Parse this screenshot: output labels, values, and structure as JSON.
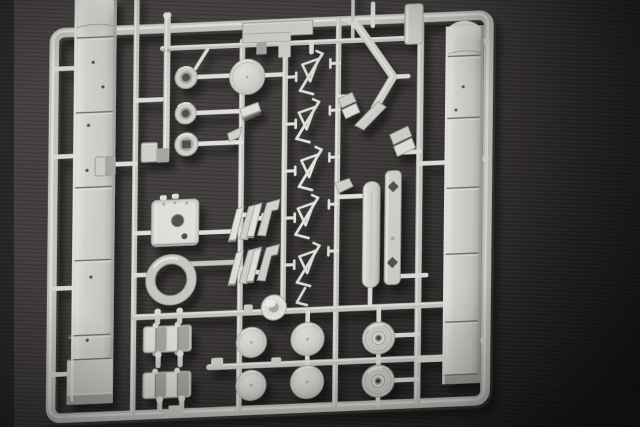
{
  "scene": {
    "type": "photograph",
    "subject": "Light grey injection-moulded model kit sprue (parts tree) photographed on dark grey fabric",
    "background": "dark charcoal fabric with vignetting, darker toward right edge and corners",
    "lighting": "flash from upper left; parts cast soft shadows down and to the right"
  },
  "colors": {
    "bg_base": "#433f3d",
    "bg_dark": "#1c1919",
    "bg_edge": "#0d0b0b",
    "runner": "#ccd0c9",
    "plastic": "#d4d7d1",
    "plastic_bright": "#e6e8e3",
    "plastic_highlight": "#f4f5f1",
    "plastic_shadow": "#a8aba5",
    "plastic_dark": "#6e716b",
    "crevice": "#504e48"
  },
  "sprue": {
    "frame": "rounded rectangular outer runner, slightly tilted (right side higher)",
    "interior_runners": [
      "5 vertical rails",
      "top cross rail",
      "two lower cross rails",
      "many short feed stubs"
    ],
    "parts": [
      {
        "id": "left-fender",
        "label": "long segmented fender strip with rolled top and locating holes (left side)"
      },
      {
        "id": "right-fender",
        "label": "long segmented fender strip with rolled top (right side)"
      },
      {
        "id": "gun-barrel",
        "label": "thin gun-barrel rod (upper middle)"
      },
      {
        "id": "hub-rings",
        "label": "column of three small wheel hubs / ring parts"
      },
      {
        "id": "hatch-disc",
        "label": "round hatch disc"
      },
      {
        "id": "turret-box",
        "label": "rectangular turret block with two round openings"
      },
      {
        "id": "large-ring",
        "label": "large open ring (turret race)"
      },
      {
        "id": "zigzag-chain",
        "label": "vertical chain of thin zig-zag parts with hollow triangles"
      },
      {
        "id": "wedge-pairs",
        "label": "two rows of paired slanted bracket parts"
      },
      {
        "id": "right-wedges",
        "label": "small slanted plate parts right of the chain"
      },
      {
        "id": "arrow-bracket",
        "label": "large chevron / arrow-shaped bracket (top right)"
      },
      {
        "id": "roof-plate",
        "label": "flat stepped plate with hanging tabs (top middle)"
      },
      {
        "id": "hanging-block",
        "label": "small block hanging from top rail (right)"
      },
      {
        "id": "support-bar",
        "label": "rounded vertical support bar"
      },
      {
        "id": "plate-bar",
        "label": "flat bar with diamond cut-outs"
      },
      {
        "id": "track-links",
        "label": "two track-link clusters with round-tipped sprue pins"
      },
      {
        "id": "road-wheels",
        "label": "four plain round road wheels (bottom)"
      },
      {
        "id": "hub-wheels",
        "label": "two road wheels with raised hubs and centre holes"
      },
      {
        "id": "small-wheel",
        "label": "small bright toothed idler wheel"
      },
      {
        "id": "small-boxes",
        "label": "three small box parts near the left middle rail"
      }
    ]
  }
}
